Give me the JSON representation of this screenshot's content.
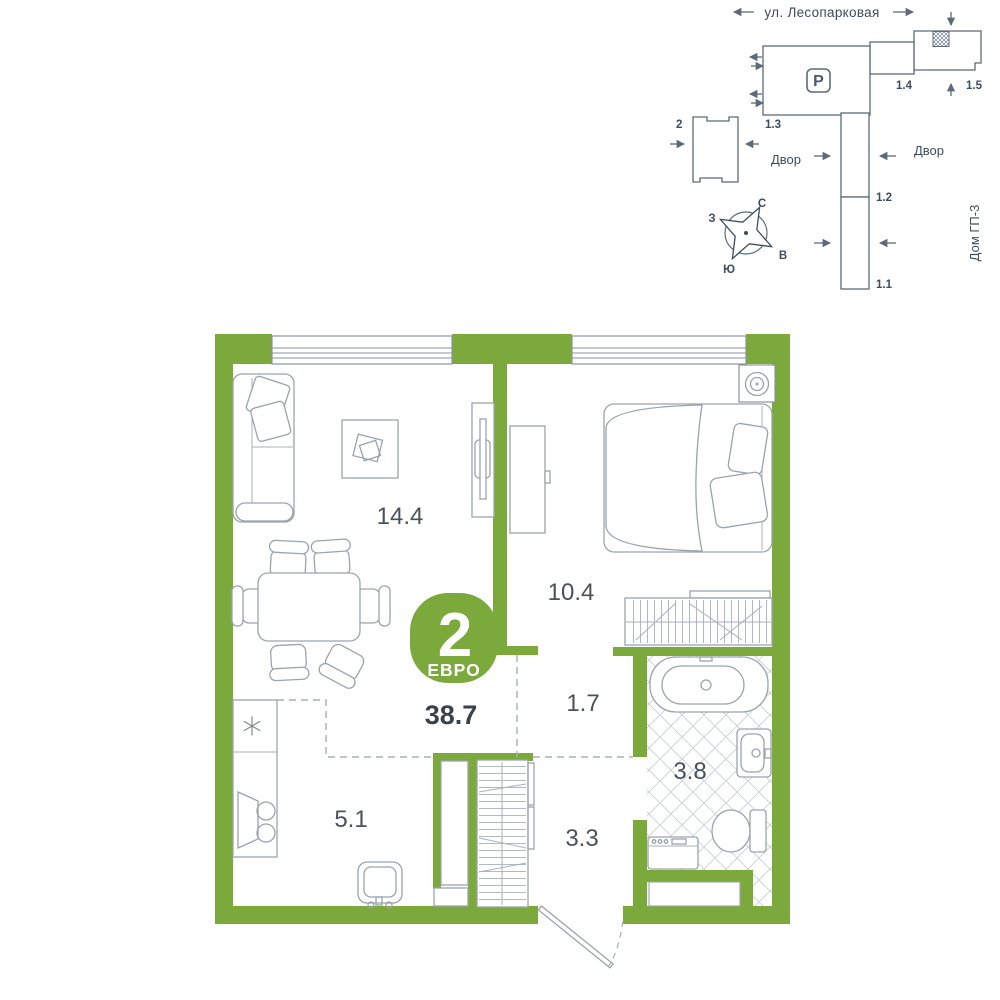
{
  "site_plan": {
    "street_label": "ул. Лесопарковая",
    "parking_label": "Р",
    "yard_left": "Двор",
    "yard_right": "Двор",
    "house_label": "Дом ГП-3",
    "buildings": {
      "b2": "2",
      "b1_3": "1.3",
      "b1_4": "1.4",
      "b1_5": "1.5",
      "b1_2": "1.2",
      "b1_1": "1.1"
    },
    "compass": {
      "n": "С",
      "s": "Ю",
      "w": "З",
      "e": "В"
    }
  },
  "floor_plan": {
    "badge": {
      "rooms": "2",
      "type": "ЕВРО",
      "total_area": "38.7"
    },
    "areas": {
      "living": "14.4",
      "bedroom": "10.4",
      "corridor": "1.7",
      "bathroom": "3.8",
      "hallway": "3.3",
      "kitchen": "5.1"
    }
  },
  "colors": {
    "accent_green": "#7CA93B",
    "site_line": "#5C6B7A",
    "furniture_line": "#9AA3AD",
    "tile_line": "#CBD1D6",
    "text_dark": "#39424B",
    "text_area": "#49525B"
  }
}
